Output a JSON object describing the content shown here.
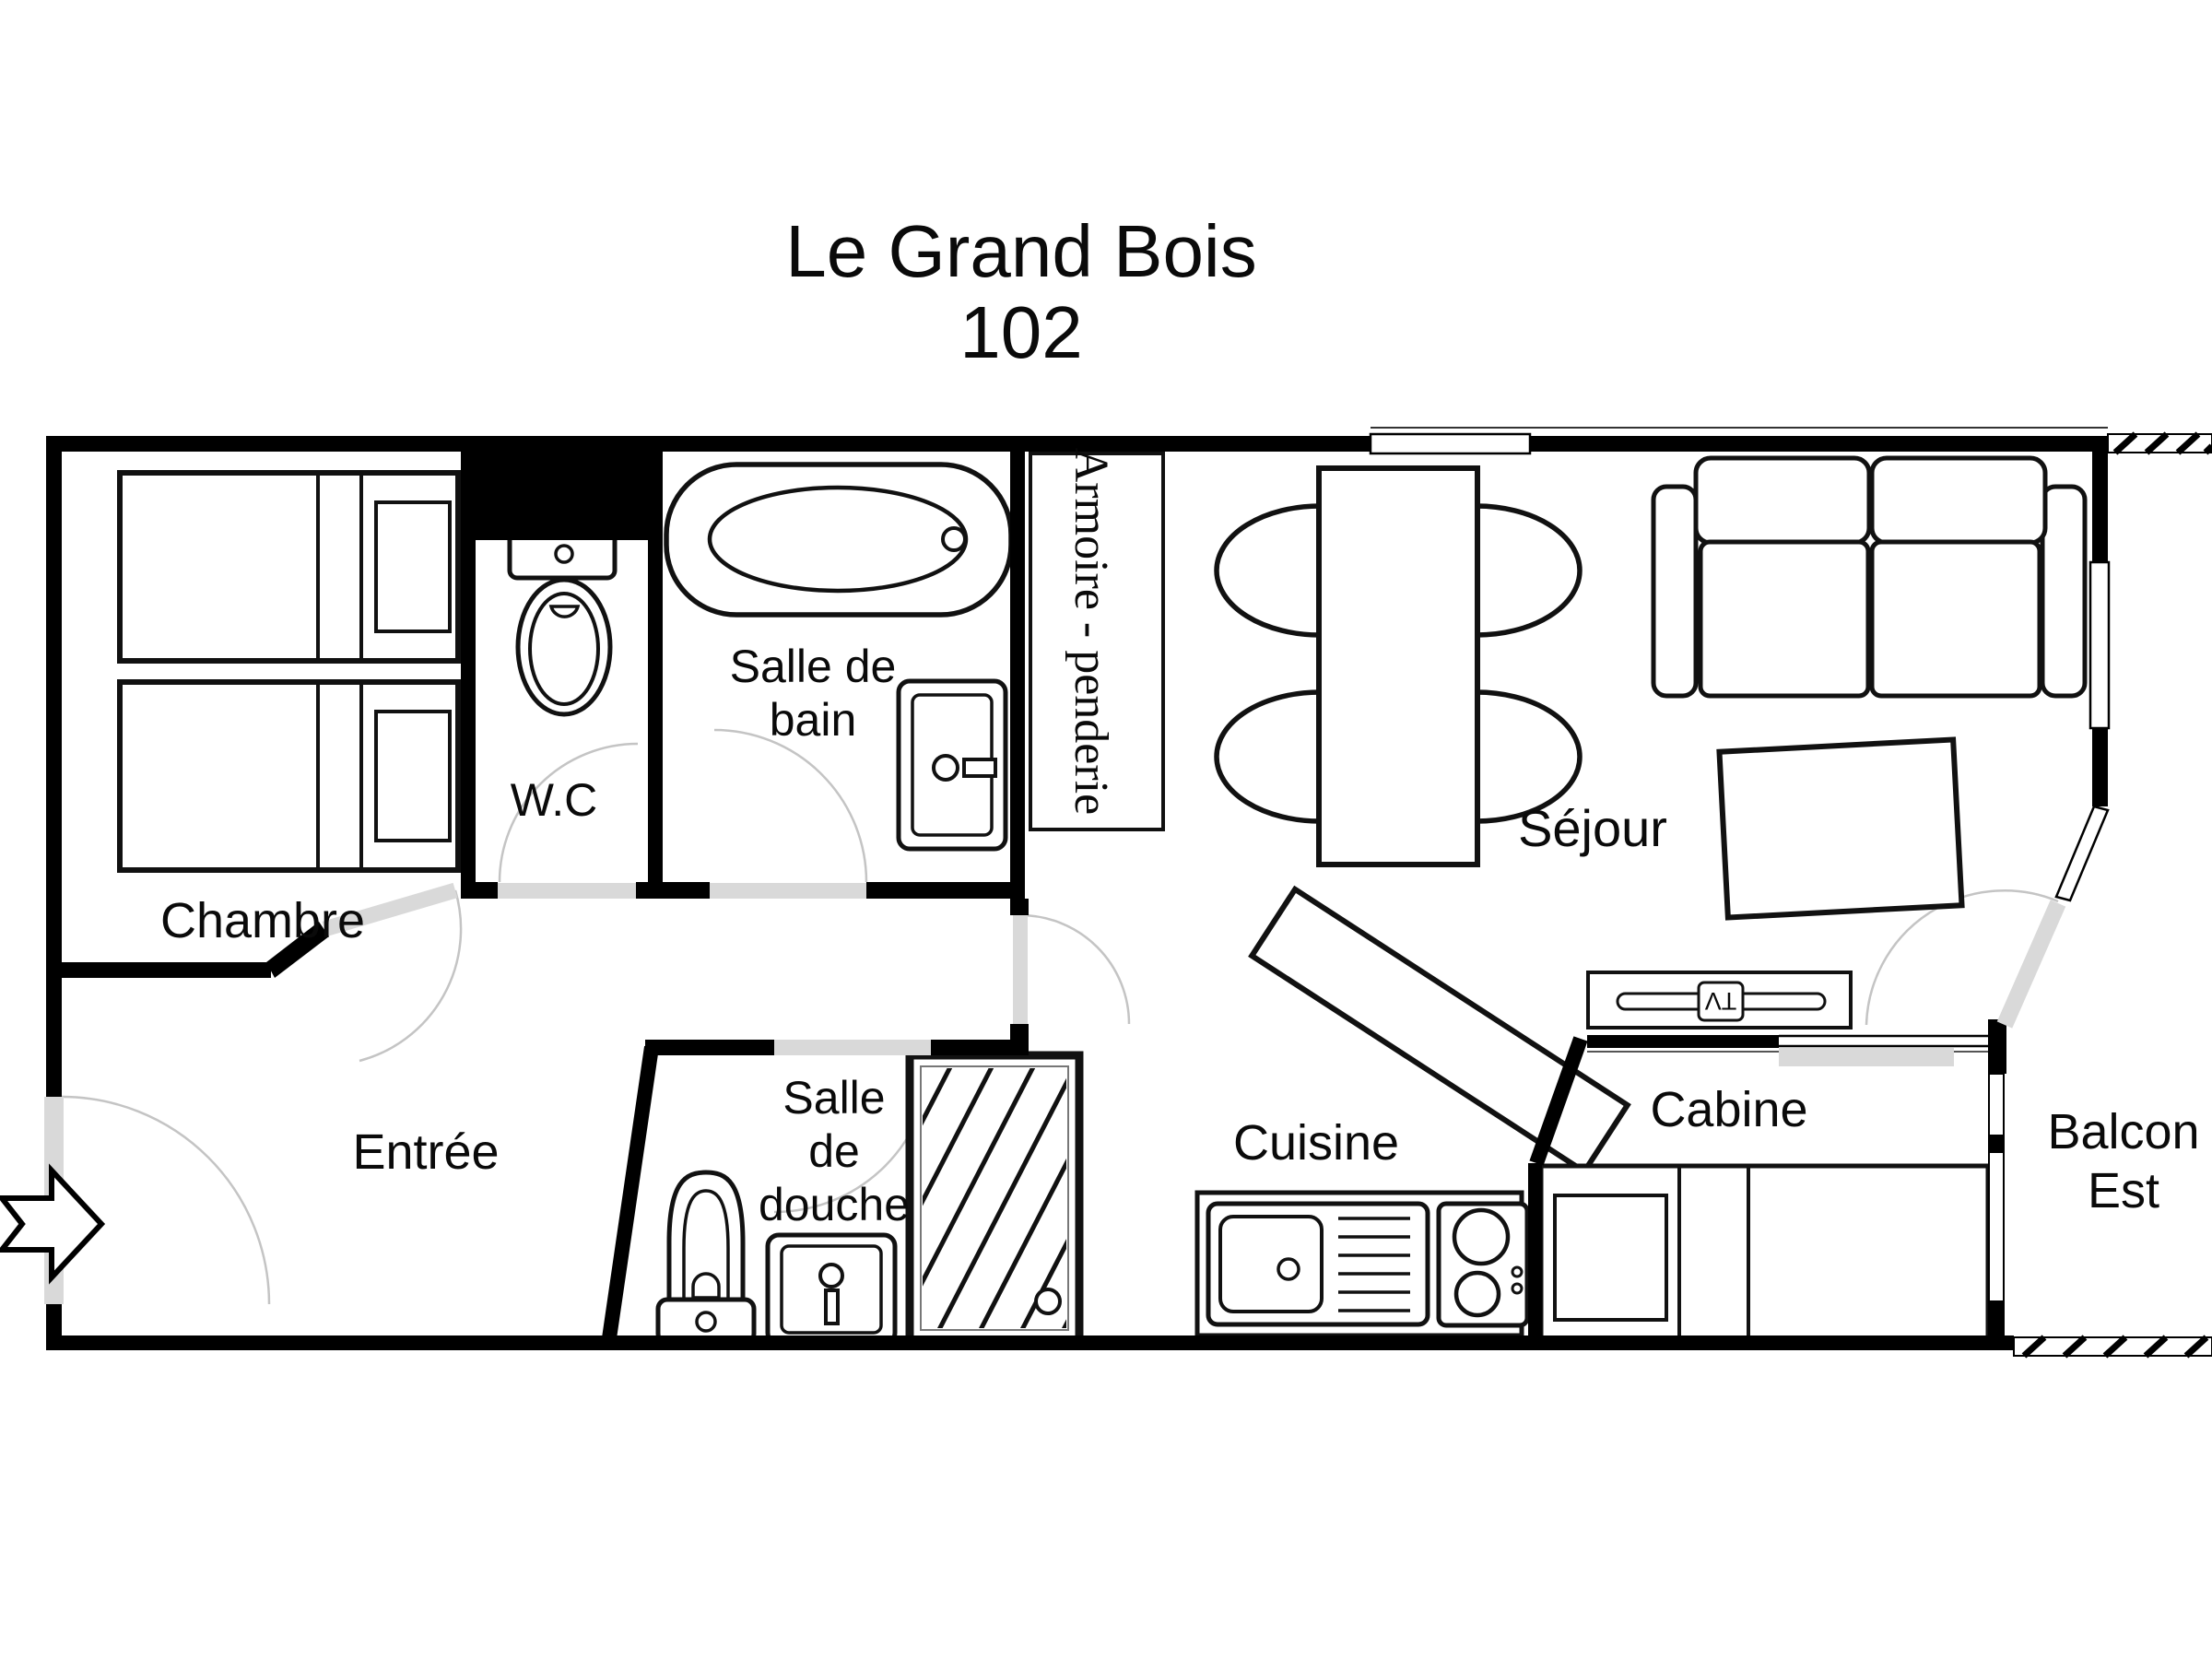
{
  "title": {
    "line1": "Le Grand Bois",
    "line2": "102"
  },
  "rooms": {
    "chambre": {
      "label": "Chambre"
    },
    "wc": {
      "label": "W.C"
    },
    "salle_de_bain": {
      "label_line1": "Salle de",
      "label_line2": "bain"
    },
    "armoire": {
      "label": "Armoire - penderie"
    },
    "sejour": {
      "label": "Séjour"
    },
    "entree": {
      "label": "Entrée"
    },
    "salle_de_douche": {
      "label_line1": "Salle",
      "label_line2": "de",
      "label_line3": "douche"
    },
    "cuisine": {
      "label": "Cuisine"
    },
    "cabine": {
      "label": "Cabine"
    },
    "balcon_est": {
      "label_line1": "Balcon",
      "label_line2": "Est"
    }
  },
  "fixtures": {
    "tv_label": "TV"
  },
  "colors": {
    "wall": "#000000",
    "door_leaf": "#d9d9d9",
    "door_arc": "#c4c4c4",
    "background": "#ffffff",
    "furniture_stroke": "#111111"
  }
}
